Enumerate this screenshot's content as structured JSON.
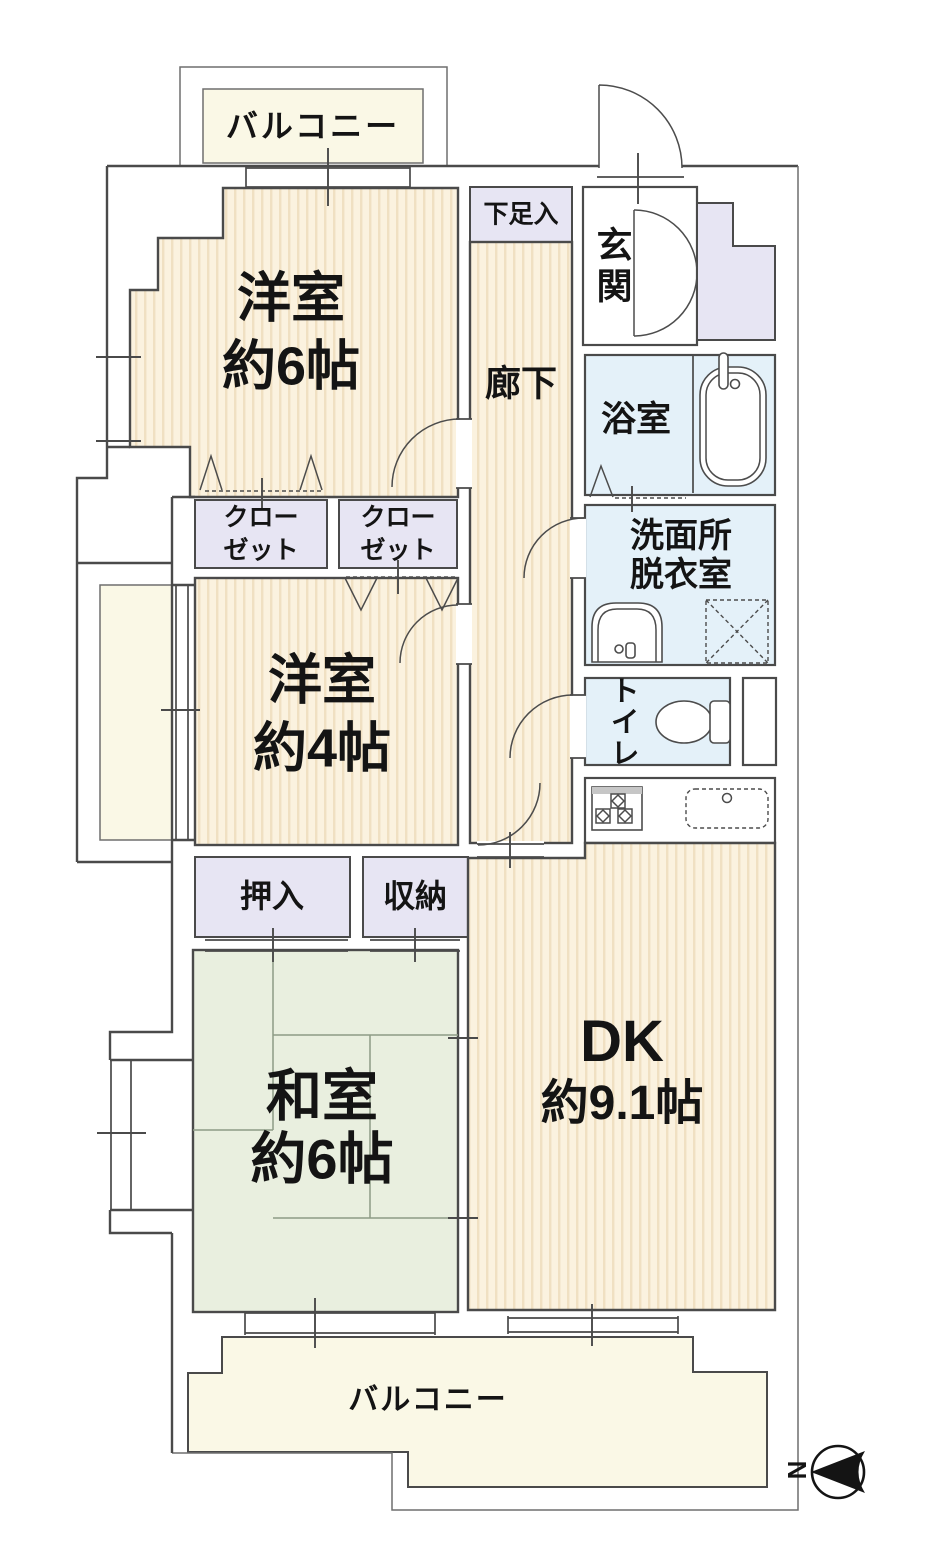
{
  "floorplan": {
    "rooms": {
      "balcony_top": {
        "label": "バルコニー"
      },
      "western_room_6": {
        "label": "洋室",
        "size": "約6帖"
      },
      "shoe_cabinet": {
        "label": "下足入"
      },
      "entrance": {
        "label": "玄関"
      },
      "corridor": {
        "label": "廊下"
      },
      "bathroom": {
        "label": "浴室"
      },
      "washroom": {
        "label_line1": "洗面所",
        "label_line2": "脱衣室"
      },
      "closet_a": {
        "label_line1": "クロー",
        "label_line2": "ゼット"
      },
      "closet_b": {
        "label_line1": "クロー",
        "label_line2": "ゼット"
      },
      "western_room_4": {
        "label": "洋室",
        "size": "約4帖"
      },
      "toilet": {
        "label": "トイレ"
      },
      "oshiire": {
        "label": "押入"
      },
      "storage": {
        "label": "収納"
      },
      "japanese_room_6": {
        "label": "和室",
        "size": "約6帖"
      },
      "dining_kitchen": {
        "label": "DK",
        "size": "約9.1帖"
      },
      "balcony_bottom": {
        "label": "バルコニー"
      }
    },
    "compass": {
      "north_label": "N"
    },
    "colors": {
      "wall": "#4a4a4a",
      "floor_base": "#FBF2DF",
      "floor_stripe": "#F0E0C2",
      "tatami": "#E9EFDF",
      "wet_area": "#E4F1F9",
      "closet": "#E7E5F3",
      "balcony": "#FAF8E6"
    }
  }
}
